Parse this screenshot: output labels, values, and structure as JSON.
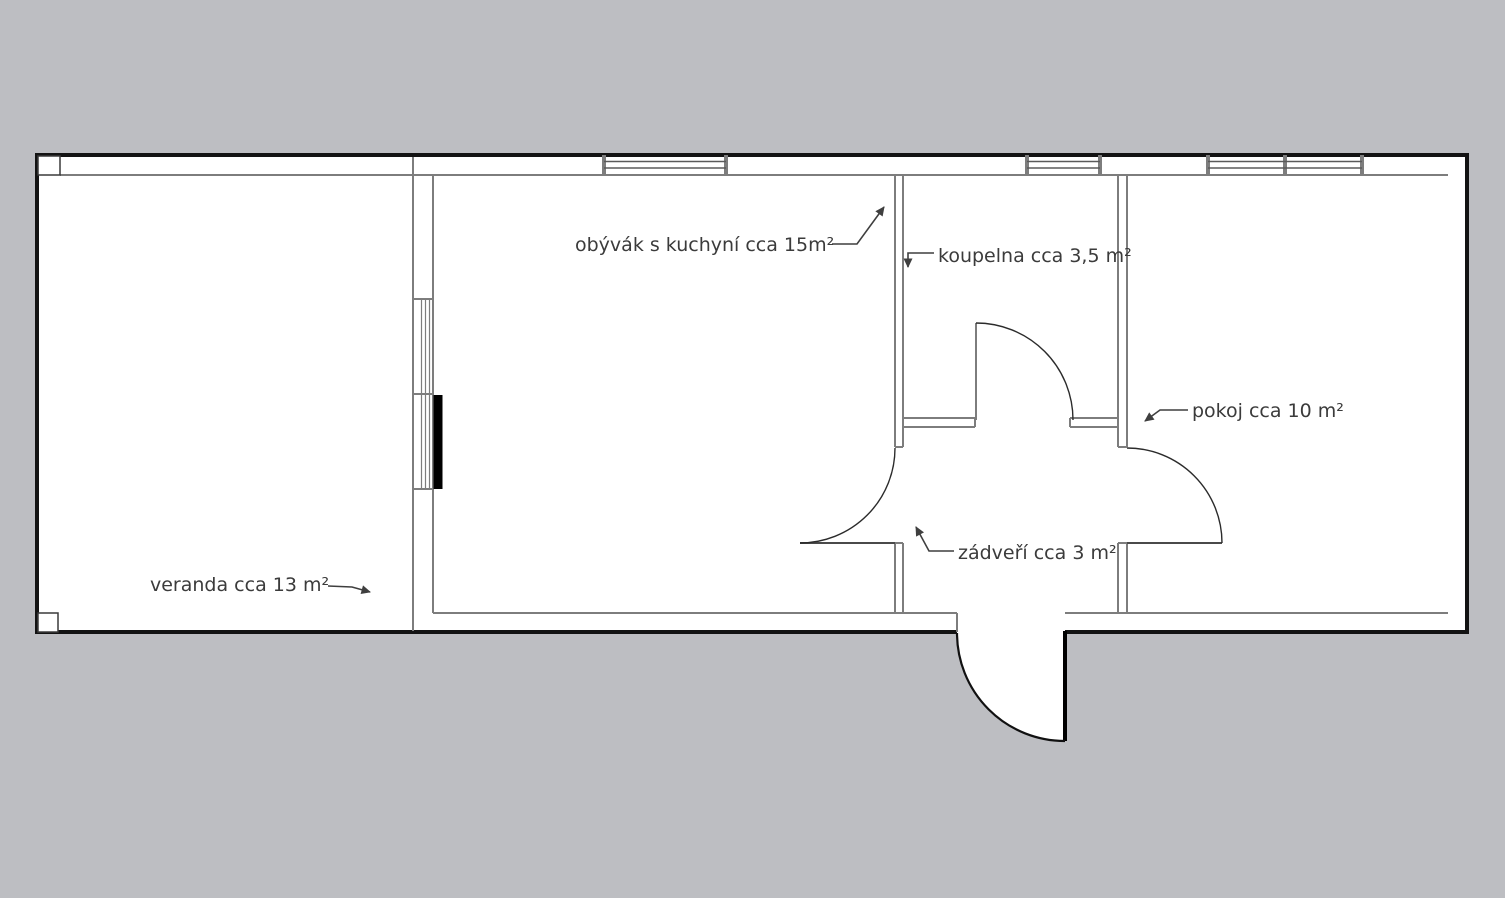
{
  "title": "floor plan",
  "colors": {
    "background": "#bdbec2",
    "floor": "#ffffff",
    "outer_wall": "#131313",
    "interior_line": "#7d7d7d",
    "text": "#3b3b3b",
    "door_leaf_black": "#000000"
  },
  "labels": {
    "living_room": "obývák s kuchyní cca 15m²",
    "bathroom": "koupelna cca 3,5 m²",
    "room": "pokoj cca 10 m²",
    "hall": "zádveří cca 3 m²",
    "veranda": "veranda cca 13 m²"
  }
}
